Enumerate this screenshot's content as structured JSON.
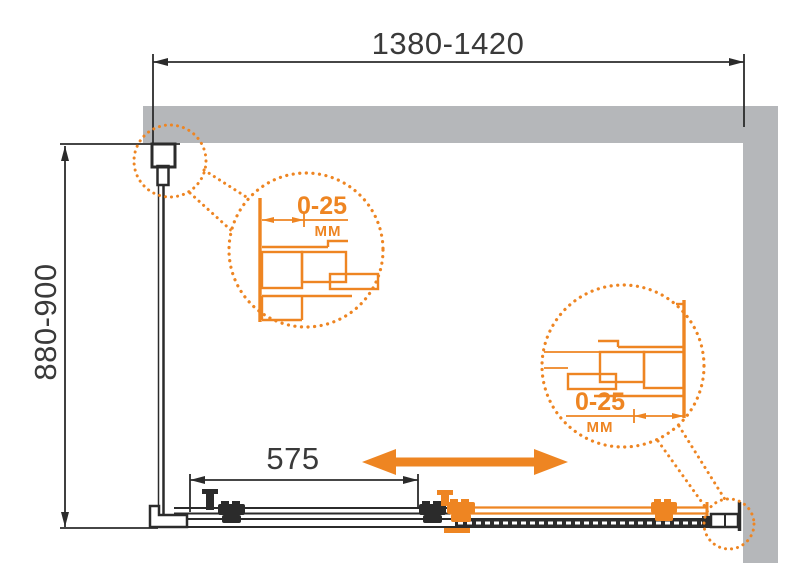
{
  "dimensions": {
    "width": "1380-1420",
    "height": "880-900",
    "door_width": "575"
  },
  "details": [
    {
      "range": "0-25",
      "unit": "MM"
    },
    {
      "range": "0-25",
      "unit": "MM"
    }
  ],
  "colors": {
    "accent_orange": "#EE8522",
    "wall_gray": "#B5B7BA",
    "line_black": "#2B2B2B"
  }
}
